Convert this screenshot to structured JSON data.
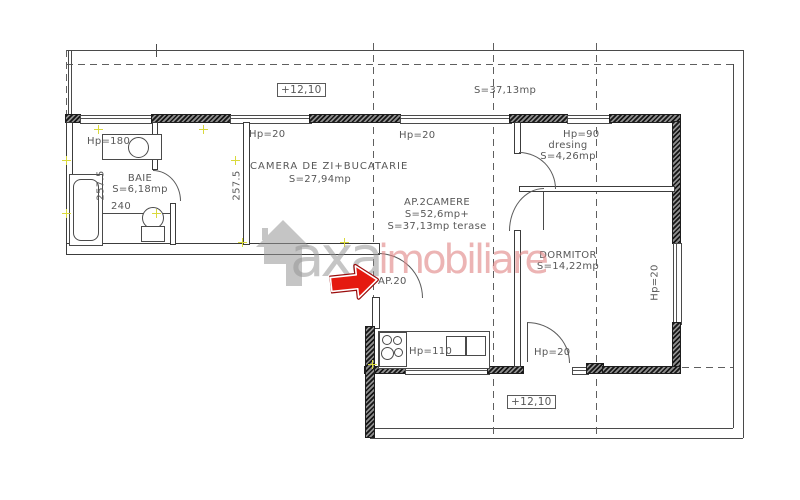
{
  "levels": {
    "top": "+12,10",
    "bottom": "+12,10"
  },
  "terrace": {
    "area": "S=37,13mp"
  },
  "apartment": {
    "name": "AP.2CAMERE",
    "area_line1": "S=52,6mp+",
    "area_line2": "S=37,13mp terase",
    "entry_label": "AP.20"
  },
  "rooms": {
    "baie": {
      "name": "BAIE",
      "area": "S=6,18mp"
    },
    "living": {
      "name": "CAMERA DE ZI+BUCATARIE",
      "area": "S=27,94mp"
    },
    "dresing": {
      "name": "dresing",
      "area": "S=4,26mp"
    },
    "dormitor": {
      "name": "DORMITOR",
      "area": "S=14,22mp"
    }
  },
  "openings": {
    "bath_window": "Hp=180",
    "living_window_1": "Hp=20",
    "living_window_2": "Hp=20",
    "dresing_window": "Hp=90",
    "kitchen_window": "Hp=110",
    "dormitor_door": "Hp=20",
    "dormitor_window": "Hp=20"
  },
  "dimensions": {
    "bath_width": "240",
    "bath_height": "257.5",
    "living_height": "257.5"
  },
  "watermark": {
    "prefix": "axa",
    "suffix": "imobiliare"
  },
  "colors": {
    "line": "#4a4a4a",
    "text": "#585858",
    "arrow_red": "#e51a10",
    "watermark_gray": "#969696",
    "watermark_pink": "#e08282",
    "marker_yellow": "#d9d93c"
  }
}
